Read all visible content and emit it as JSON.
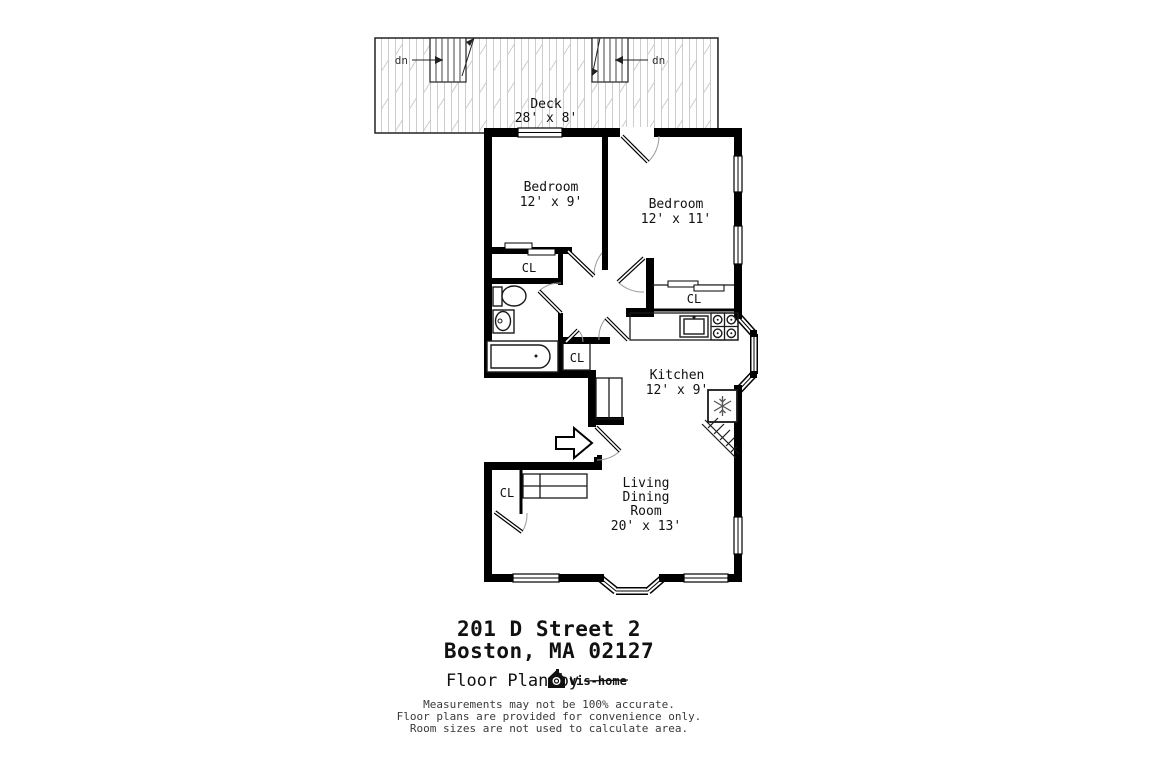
{
  "plan": {
    "deck": {
      "label": "Deck",
      "dims": "28' x 8'"
    },
    "stairs": {
      "left_label": "dn",
      "right_label": "dn"
    },
    "bedroom1": {
      "label": "Bedroom",
      "dims": "12' x 9'"
    },
    "bedroom2": {
      "label": "Bedroom",
      "dims": "12' x 11'"
    },
    "kitchen": {
      "label": "Kitchen",
      "dims": "12' x 9'"
    },
    "living": {
      "line1": "Living",
      "line2": "Dining",
      "line3": "Room",
      "dims": "20' x 13'"
    },
    "closets": {
      "bath": "CL",
      "bedroom2": "CL",
      "hall": "CL",
      "living": "CL"
    }
  },
  "footer": {
    "address_line1": "201 D Street 2",
    "address_line2": "Boston, MA 02127",
    "credit_prefix": "Floor Plan by",
    "brand": "vis-home",
    "disclaimer_line1": "Measurements may not be 100% accurate.",
    "disclaimer_line2": "Floor plans are provided for convenience only.",
    "disclaimer_line3": "Room sizes are not used to calculate area."
  },
  "colors": {
    "ink": "#111111",
    "wall": "#000000",
    "deck_grain": "#cccccc",
    "door_arc": "#9a9a9a"
  }
}
